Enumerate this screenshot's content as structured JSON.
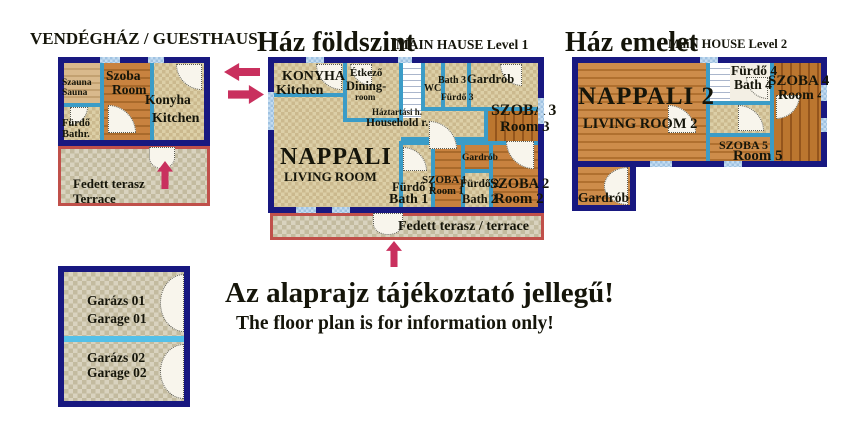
{
  "colors": {
    "wall_navy": "#181880",
    "partition_teal": "#3b9cc7",
    "window_blue": "#aecde9",
    "terrace_border_red": "#c0504a",
    "arrow_crimson": "#c9305e",
    "floor_tile_beige": "#d9c9a2",
    "floor_wood": "#c07c3c",
    "floor_tile_grey": "#d2cab2",
    "garage_divider_blue": "#54c0e8"
  },
  "guesthouse": {
    "title": "VENDÉGHÁZ / GUESTHAUS",
    "rooms": {
      "sauna_hu": "Szauna",
      "sauna_en": "Sauna",
      "room_hu": "Szoba",
      "room_en": "Room",
      "kitchen_hu": "Konyha",
      "kitchen_en": "Kitchen",
      "bath_hu": "Fürdő",
      "bath_en": "Bathr.",
      "terrace_hu": "Fedett terasz",
      "terrace_en": "Terrace"
    }
  },
  "main_level1": {
    "title": "Ház földszint",
    "subtitle": "MAIN HAUSE Level 1",
    "rooms": {
      "kitchen_hu": "KONYHA",
      "kitchen_en": "Kitchen",
      "dining_hu": "Étkező",
      "dining_en1": "Dining-",
      "dining_en2": "room",
      "wc": "WC",
      "bath3_en": "Bath 3",
      "bath3_hu": "Fürdő 3",
      "wardrobe_top": "Gardrób",
      "room3_hu": "SZOBA 3",
      "room3_en": "Room 3",
      "household_hu": "Háztartási h.",
      "household_en": "Household r.",
      "living_hu": "NAPPALI",
      "living_en": "LIVING ROOM",
      "bath1_hu": "Fürdő 1",
      "bath1_en": "Bath 1",
      "room1_hu": "SZOBA 1",
      "room1_en": "Room 1",
      "wardrobe_mid": "Gardrób",
      "bath2_hu": "Fürdő 2",
      "bath2_en": "Bath 2",
      "room2_hu": "SZOBA 2",
      "room2_en": "Room 2",
      "terrace": "Fedett terasz / terrace"
    }
  },
  "main_level2": {
    "title": "Ház emelet",
    "subtitle": "MaiN HOUSE Level 2",
    "rooms": {
      "living_hu": "NAPPALI 2",
      "living_en": "LIVING ROOM 2",
      "bath4_hu": "Fürdő 4",
      "bath4_en": "Bath 4",
      "room4_hu": "SZOBA 4",
      "room4_en": "Room 4",
      "room5_hu": "SZOBA 5",
      "room5_en": "Room 5",
      "wardrobe": "Gardrób"
    }
  },
  "garage": {
    "g1_hu": "Garázs 01",
    "g1_en": "Garage 01",
    "g2_hu": "Garázs 02",
    "g2_en": "Garage 02"
  },
  "disclaimer": {
    "hu": "Az alaprajz tájékoztató jellegű!",
    "en": "The floor plan is for information only!"
  }
}
